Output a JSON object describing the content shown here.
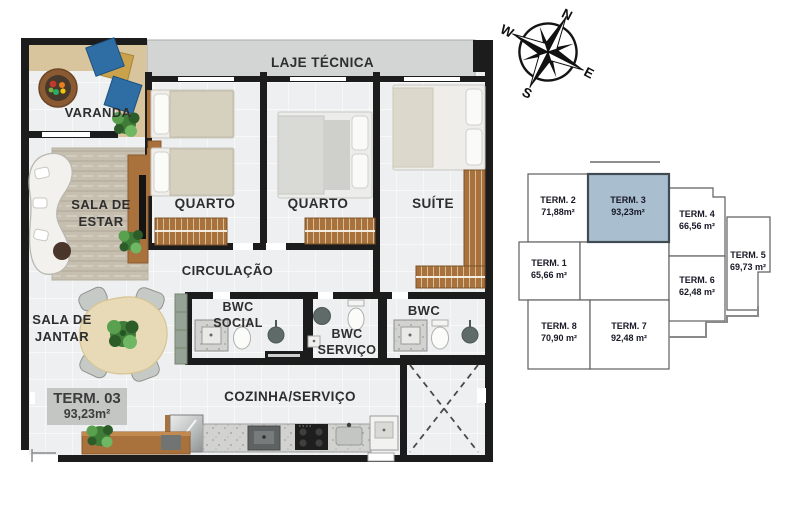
{
  "floor_plan": {
    "rooms": {
      "varanda": "VARANDA",
      "laje_tecnica": "LAJE TÉCNICA",
      "sala_de_estar": "SALA DE ESTAR",
      "quarto_1": "QUARTO",
      "quarto_2": "QUARTO",
      "suite": "SUÍTE",
      "circulacao": "CIRCULAÇÃO",
      "bwc_social": "BWC SOCIAL",
      "bwc_servico": "BWC SERVIÇO",
      "bwc_suite": "BWC",
      "sala_de_jantar": "SALA DE JANTAR",
      "cozinha_servico": "COZINHA/SERVIÇO"
    },
    "unit_badge": {
      "unit": "TERM. 03",
      "area": "93,23m²"
    },
    "colors": {
      "wall": "#1c1c1c",
      "laje_fill": "#d3d5d5",
      "deck": "#d8c59e",
      "wood": "#a9713c"
    }
  },
  "key_plan": {
    "highlight_color": "#a9bfcf",
    "units": [
      {
        "label": "TERM. 1",
        "area": "65,66 m²",
        "highlighted": false
      },
      {
        "label": "TERM. 2",
        "area": "71,88m²",
        "highlighted": false
      },
      {
        "label": "TERM. 3",
        "area": "93,23m²",
        "highlighted": true
      },
      {
        "label": "TERM. 4",
        "area": "66,56 m²",
        "highlighted": false
      },
      {
        "label": "TERM. 5",
        "area": "69,73 m²",
        "highlighted": false
      },
      {
        "label": "TERM. 6",
        "area": "62,48 m²",
        "highlighted": false
      },
      {
        "label": "TERM. 7",
        "area": "92,48 m²",
        "highlighted": false
      },
      {
        "label": "TERM. 8",
        "area": "70,90 m²",
        "highlighted": false
      }
    ]
  },
  "compass": {
    "n": "N",
    "e": "E",
    "s": "S",
    "w": "W"
  }
}
